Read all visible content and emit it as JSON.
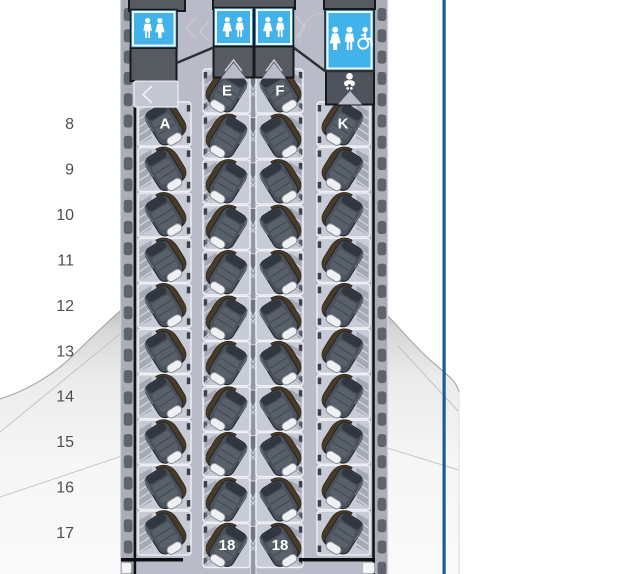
{
  "seat_map": {
    "title": "cabin-seat-map",
    "row_numbers": [
      "8",
      "9",
      "10",
      "11",
      "12",
      "13",
      "14",
      "15",
      "16",
      "17"
    ],
    "columns": [
      {
        "letter": "A",
        "rows": [
          "8",
          "9",
          "10",
          "11",
          "12",
          "13",
          "14",
          "15",
          "16",
          "17"
        ],
        "labeled_seats": {
          "8": "A"
        }
      },
      {
        "letter": "E",
        "rows": [
          "8",
          "9",
          "10",
          "11",
          "12",
          "13",
          "14",
          "15",
          "16",
          "17",
          "18"
        ],
        "labeled_seats": {
          "8": "E",
          "18": "18"
        }
      },
      {
        "letter": "F",
        "rows": [
          "8",
          "9",
          "10",
          "11",
          "12",
          "13",
          "14",
          "15",
          "16",
          "17",
          "18"
        ],
        "labeled_seats": {
          "8": "F",
          "18": "18"
        }
      },
      {
        "letter": "K",
        "rows": [
          "8",
          "9",
          "10",
          "11",
          "12",
          "13",
          "14",
          "15",
          "16",
          "17"
        ],
        "labeled_seats": {
          "8": "K"
        }
      }
    ],
    "facilities": {
      "lavatory_front_left": {
        "icons": [
          "man-icon",
          "woman-icon"
        ]
      },
      "lavatory_center_left": {
        "icons": [
          "woman-icon",
          "man-icon"
        ]
      },
      "lavatory_center_right": {
        "icons": [
          "woman-icon",
          "man-icon"
        ]
      },
      "lavatory_accessible": {
        "icons": [
          "woman-icon",
          "man-icon",
          "wheelchair-icon"
        ]
      },
      "baby_care_station": {
        "icons": [
          "baby-icon"
        ]
      },
      "galleys": [
        "galley-front-left",
        "galley-front-center",
        "galley-front-right"
      ]
    },
    "colors": {
      "lavatory_blue": "#41b3ea",
      "floor_gray": "#b9bcc8",
      "seat_dark": "#4a515b",
      "seat_brown": "#4a3b29",
      "shell_gray": "#c7cbd6",
      "monument_dark": "#565b62",
      "wall_gray": "#aaadb5",
      "window_dark": "#5f646c",
      "console_gray": "#9aa0ab",
      "edge_line_blue": "#1a5b94",
      "row_number_gray": "#4b4f55"
    }
  }
}
